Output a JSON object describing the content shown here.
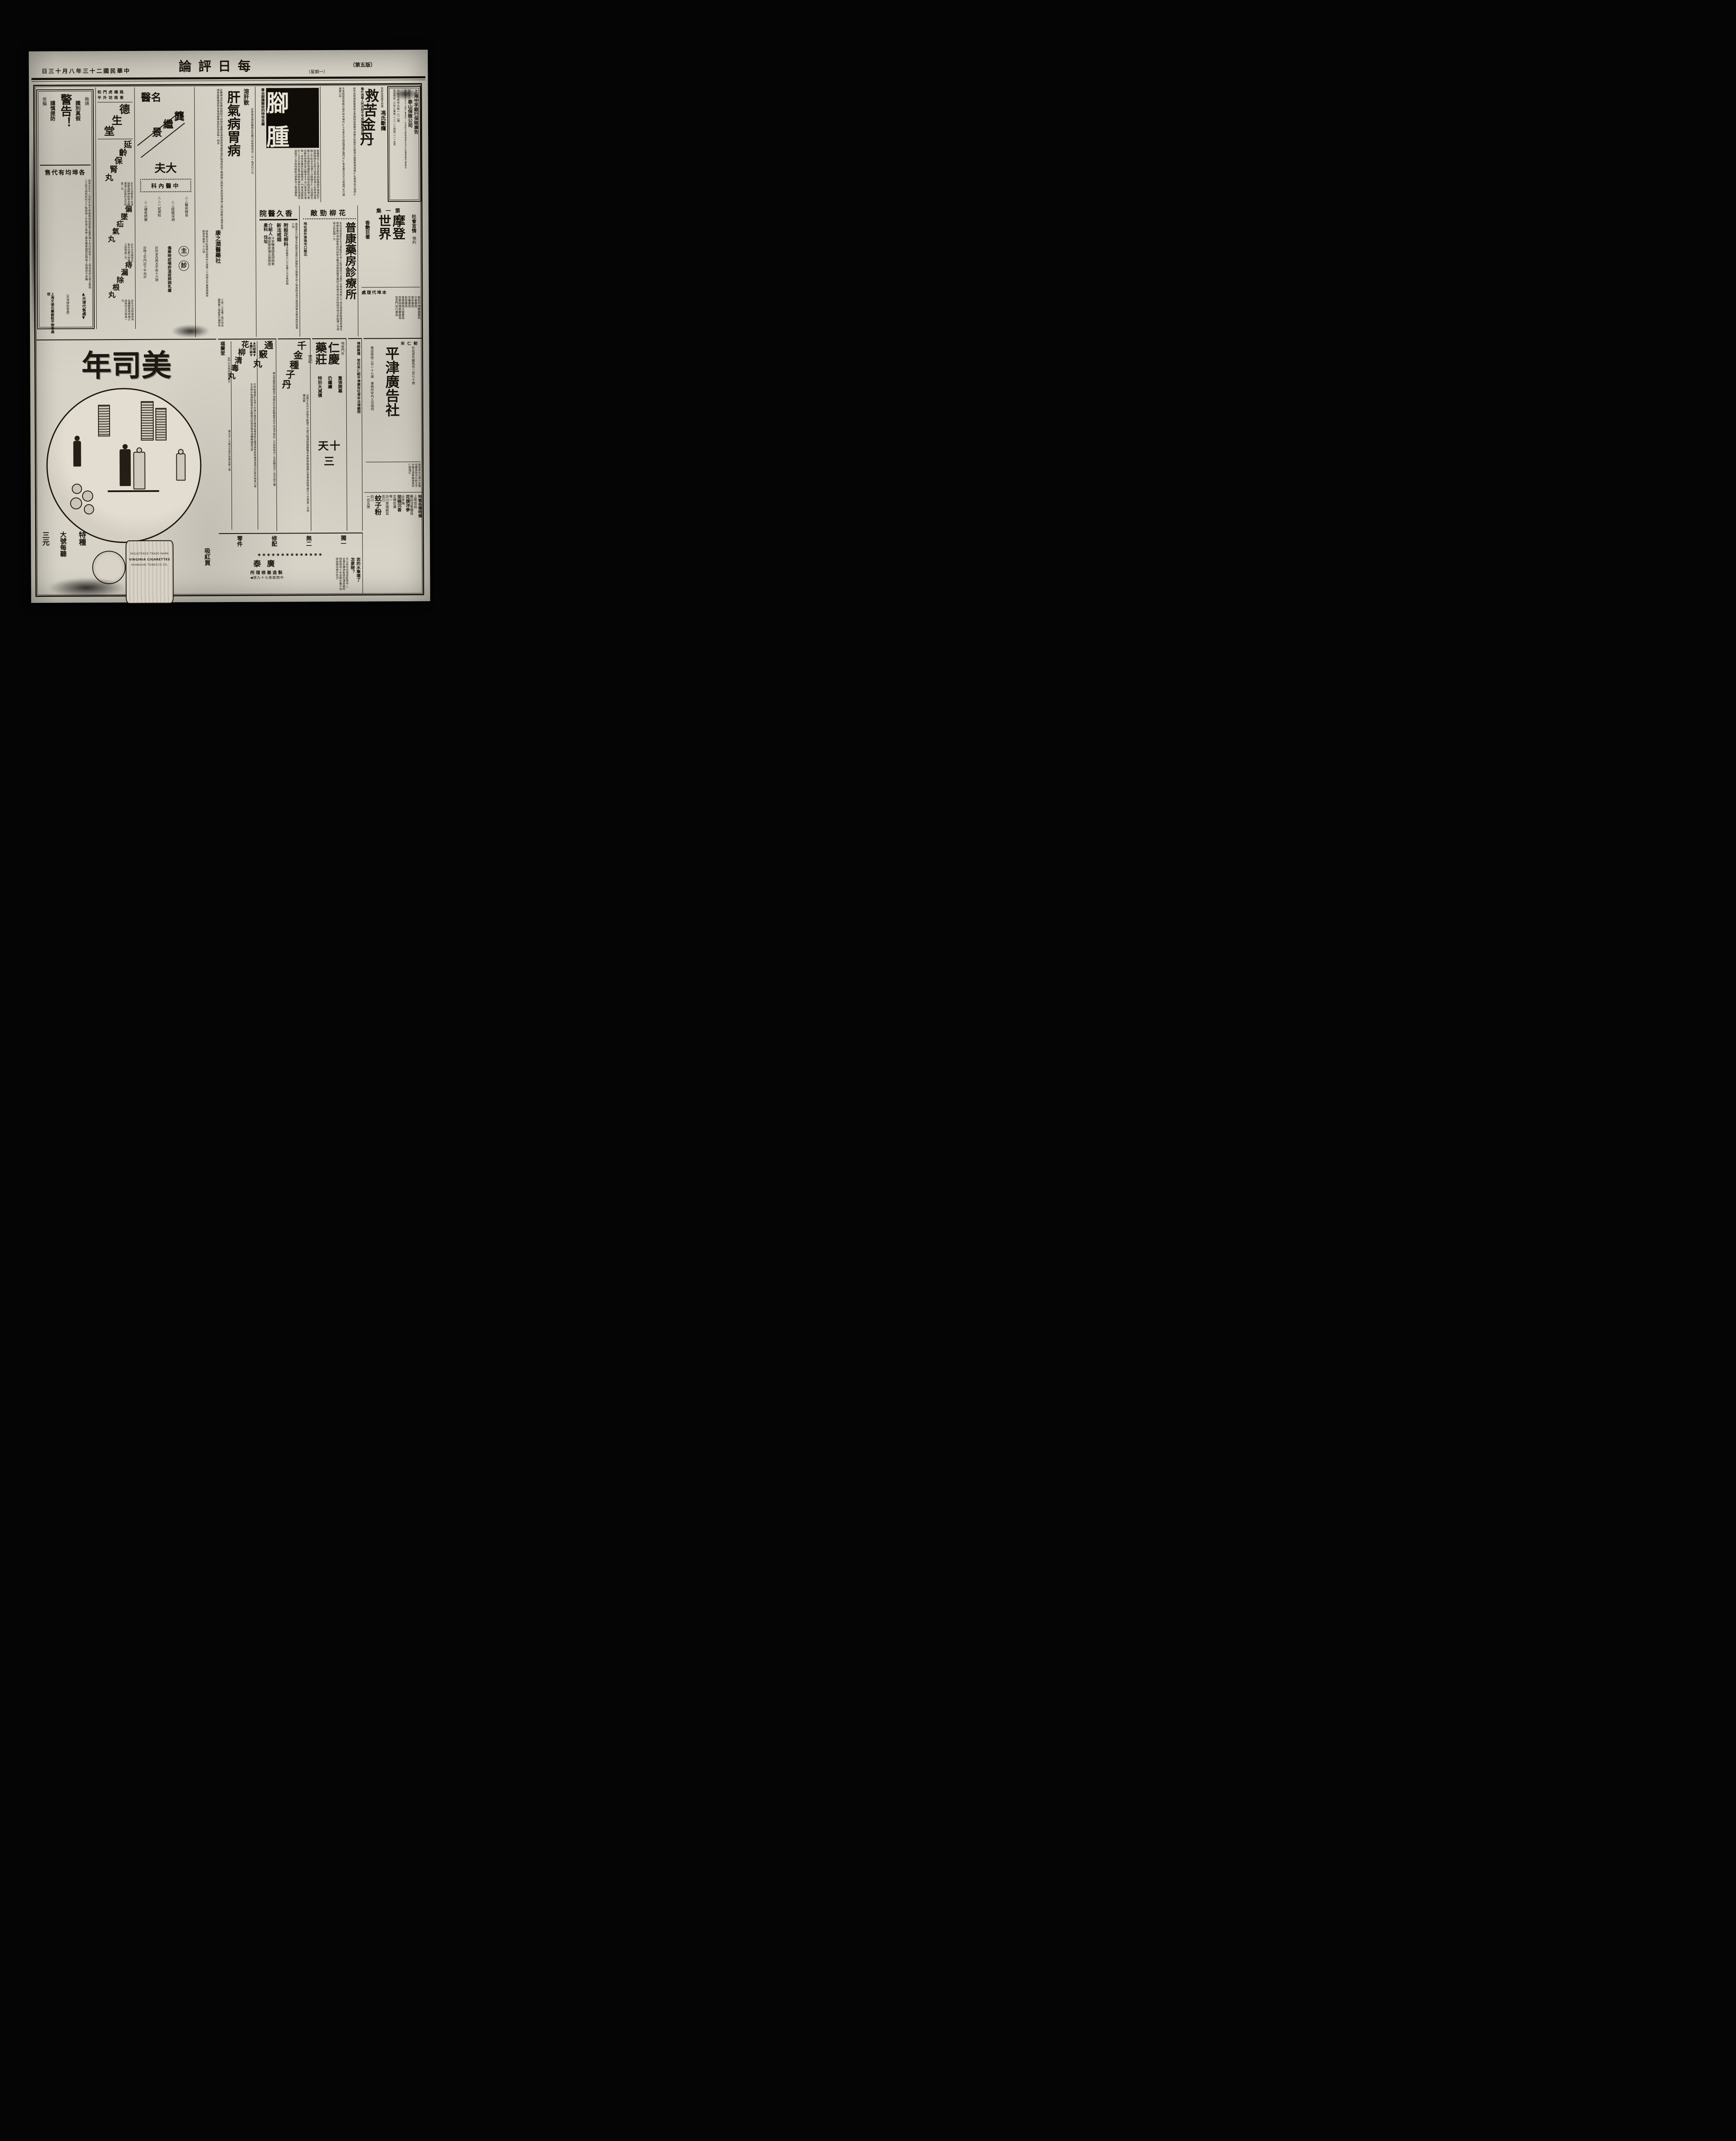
{
  "header": {
    "edition": "（第五版）",
    "weekday": "（星期一）",
    "masthead": "論評日每",
    "date": "日三十月八年三十二國民華中"
  },
  "warning": {
    "plea": "務請",
    "k1": "識別真假",
    "big": "警告！",
    "k2": "謹慎提防",
    "dupe": "受騙",
    "subhead": "售代有均埠各",
    "body": "自癸丑迄今江浙頻年發生喉癥聘請德國著名醫學博士赤白痢疾等七十二險症經部化驗立案救人之眾可想而知利之少貽誤病人生命是大害病人實多購者諸君認明瓶上商標庶不受騙",
    "dist": "▲天津代售處▼",
    "dist2": "（天津總批發處）",
    "maker": "上海文達氏藥廠駐平辦事處啓"
  },
  "desheng": {
    "addr1": "和門虎橋路",
    "addr2": "平外坊南東",
    "shop": "德生堂",
    "m1": "延齡保腎丸",
    "m1b": "此丸主治腎氣不足虛弱夢遺精神疲倦身體遺滑之症每料五元每盒一元",
    "m2": "偏墜疝氣丸",
    "m2b": "此丸主治偏墜疝氣左右牽引疼痛之症每盒二元",
    "m3": "痔漏除根丸",
    "m3b": "此丸主治痔漏淋漓血膿腫脹或疼痛之症每料五元每盒一元"
  },
  "mingyi": {
    "title": "醫名",
    "name": "龔繼景",
    "dafu": "夫大",
    "box": "科內醫中",
    "m1": "△△醫術精長",
    "m2": "△△經驗深淵",
    "m3": "△△一試便知",
    "m4": "△△確有把握",
    "zhu": "主",
    "zhen": "診",
    "spec": "傷寒時症喉痧溫疫肺病乳瘡",
    "addr": "診所宣內西太平街十六號",
    "hours": "診時上午門診下午出診"
  },
  "ganwei": {
    "side": "溶肝散",
    "side_note": "此病者宜速就醫服此良藥可恕除根特品一元一角半打六元",
    "big": "肝氣病胃病",
    "body": "此藥專治肝氣鬱結胸悶不舒情志憂鬱思慮過度氣滯暴怒傷肝胸滿氣結不暢頭痛心跳麻木食慾停滯燒心嘔吐吞酸水或停食痞塊兩脇脹痛煩悶食後燒痛專能舒肝胃症唯一純良",
    "maker": "康之澗醫藥社",
    "addr": "總售處北平新橋南石胡同內九道灣二十四號北平東單牌樓西觀音寺路南二十六號",
    "price": "小盒一元定價二角外埠函購寄費三角郵票代價照用"
  },
  "jiaozhong": {
    "big": "腳腫",
    "side": "專治脚腫臌症的特效良藥",
    "body": "脚腫臌症之先導初患時兩脚腫脹早晨復起行路猶踏棉花此病乃因腎虛氣滯久坐勞碌過度脾土不能治水濕滯下注脚腫日久上延過膝至腹以及陰處發現腫脹則成臌症胸滿氣喘小便短數危險萬狀是以醫束手不治以致患此症者無一倖免本醫研究脚腫臌症一門素有經驗能於三五日內奏效各界病家所贊許免各填道往返跋涉之苦故特精製治癒奏效之敏速勝馬"
  },
  "jindan": {
    "reg1": "商部註冊",
    "reg2": "蟾芝商標",
    "name": "馮氏斷癮",
    "big": "救苦金丹",
    "slogan": "鴉片流毒人所共知不早戒除無異自殺",
    "endorse": "經中央禁煙委員會張主席題除惡務盡中央衛生試驗所化驗津市展覽會得特獎◎社會局出示保證◎",
    "dist": "天津總號西馬路分號天祥市場內◎千芝堂北平總經理處正陽門外◎會友書社北平代售處門外打磨廠東口內"
  },
  "insurance": {
    "title": "上海中孚銀行保險廣告",
    "prefix": "茲受本行",
    "company": "泰山保險公司",
    "body": "委託經理水火人壽汽車意外一切保險手續簡便價目克已如蒙賜顧不勝歡迎",
    "addr": "行址北米市大街一六二號",
    "tel": "電話南局二六零七東局二二八一三西局二二一五零"
  },
  "xiangjiu": {
    "head": "院醫久香",
    "intro": "趙君香久行醫多年經驗宏富對於婦嬰科尤稱聖手部人等或經治愈沉痾或得親友報告故特負責介紹",
    "d1": "附設花柳科",
    "d1n": "注射最新六〇六收費三元五角起碼",
    "d2": "新法戒烟",
    "ih": "介紹人",
    "n1": "冷家驥",
    "n2": "憚質惠",
    "n3": "潘國英",
    "n4": "廖運炎",
    "n5": "胡佩衡",
    "n6": "吳雨臣",
    "d3": "產科",
    "d4": "住址"
  },
  "pukang": {
    "head": "敵勁柳花",
    "big": "普康藥房診療所",
    "body": "本所為提倡新的生活運動便利病人起見隨時可治專門治療梅毒魚口下疳白濁骨節酸痛耳鳴喉啞頭痛急慢性淋病墜等症均採新法醫治保無新舊苦痛欲注射者可到本所時間均短注射起碼二元淋病注射起碼一元",
    "addr": "地址前外東珠市口路北"
  },
  "modeng": {
    "vol": "集一第",
    "genre": "社會言情",
    "pre": "預約",
    "big": "摩登世界",
    "sub": "香艷巨著",
    "ah": "處理代埠本",
    "s0": "東安市場雙義書局",
    "s1": "文美書局",
    "s2": "會友書局",
    "s3": "京華書局",
    "s4": "新智書局",
    "s5": "青雲閣佩文齋書局",
    "s6": "西單商場東華書局",
    "s7": "宣武門知行書局"
  },
  "cig": {
    "brand": "年司美",
    "slogan": "吸紅買",
    "p1": "特種",
    "p2": "大號每聽",
    "p3": "三元",
    "tin_mark": "REGISTERED TRADE MARK",
    "tin1": "VIRGINIA CIGARETTES",
    "tin2": "SHANGHAI TOBACCO CO."
  },
  "tongqiao": {
    "big": "通竅丸",
    "body": "專治耳聾耳鳴聽音不清服此丸皆能開竅見效不效退洋每料二元試用每付二毛函購加洋二毛空函不覆"
  },
  "qingdu": {
    "b1": "▲花柳專▼",
    "b2": "▲藥行銷▼",
    "big": "花柳清毒丸",
    "body": "花柳餘毒蘊於血液之中積久毒發生楊梅結毒疳瘡紅腫潰爛骨節疼痛週身現出紅斑疹喉疼口臭手足麻木鬚眉脫落等症此藥當日除根受害非淺購藥諸君注意",
    "maker": "福蘭堂",
    "maddr": "前門外李鐵拐斜街路北",
    "price": "價大洋二元每付五角外埠寄加郵二角"
  },
  "qianjin": {
    "big": "千金種子丹",
    "body": "治男子先天不足後天虧損下元虛冷精清嗣續艱難年老精衰腦虛健忘畏寒痼症等每打十元每盒一元函購加郵"
  },
  "renqing": {
    "place": "地安門外",
    "name": "仁慶藥莊",
    "tang": "堂記",
    "e1": "重張開幕",
    "e2": "仍繼續",
    "e3": "特別大減價",
    "big": "天十三"
  },
  "lvshi": {
    "text": "律師蔡禮　受任宋仁軔平津廣告社常年法律顧問"
  },
  "pingjin": {
    "head": "宋仁軔",
    "big": "平津廣告社",
    "addr": "社址宣外騾馬市二百七十號",
    "tel": "電話南局二百一十七號",
    "office": "事務所安內土兒胡同",
    "note": "敬啓者本社專代各種怪體美術字印刷文字手續迅速惠顧諸君宋仁軔謹訂"
  },
  "sundries": {
    "t1": "特售各種特備",
    "t2": "上等佳品",
    "t3": "藥品注意優良",
    "t4": "花旗洋參",
    "t5": "尖羊角",
    "t6": "茄楠沉香",
    "t7": "定價從廉",
    "t8": "唯一",
    "t9": "白川厚樸銀耳",
    "t10": "克已",
    "t11": "蚊子粉",
    "t12": "四川",
    "t13": "一百五號"
  },
  "pen": {
    "h1": "獨一",
    "h2": "無二",
    "h3": "修配",
    "h4": "零件",
    "dots": "◉◉◉◉◉◉◉◉◉◉◉◉◉◉",
    "q1": "您的水筆壞了",
    "q2": "怎麼辦？",
    "body": "可以來所修理或配零件○定價低廉准能使您滿意敝所特製保用十年金鋼水筆不怕摔碰價目格外克已",
    "maker": "泰廣",
    "mline": "所理修兼造製",
    "maddr": "◀號九十七南路間中"
  }
}
